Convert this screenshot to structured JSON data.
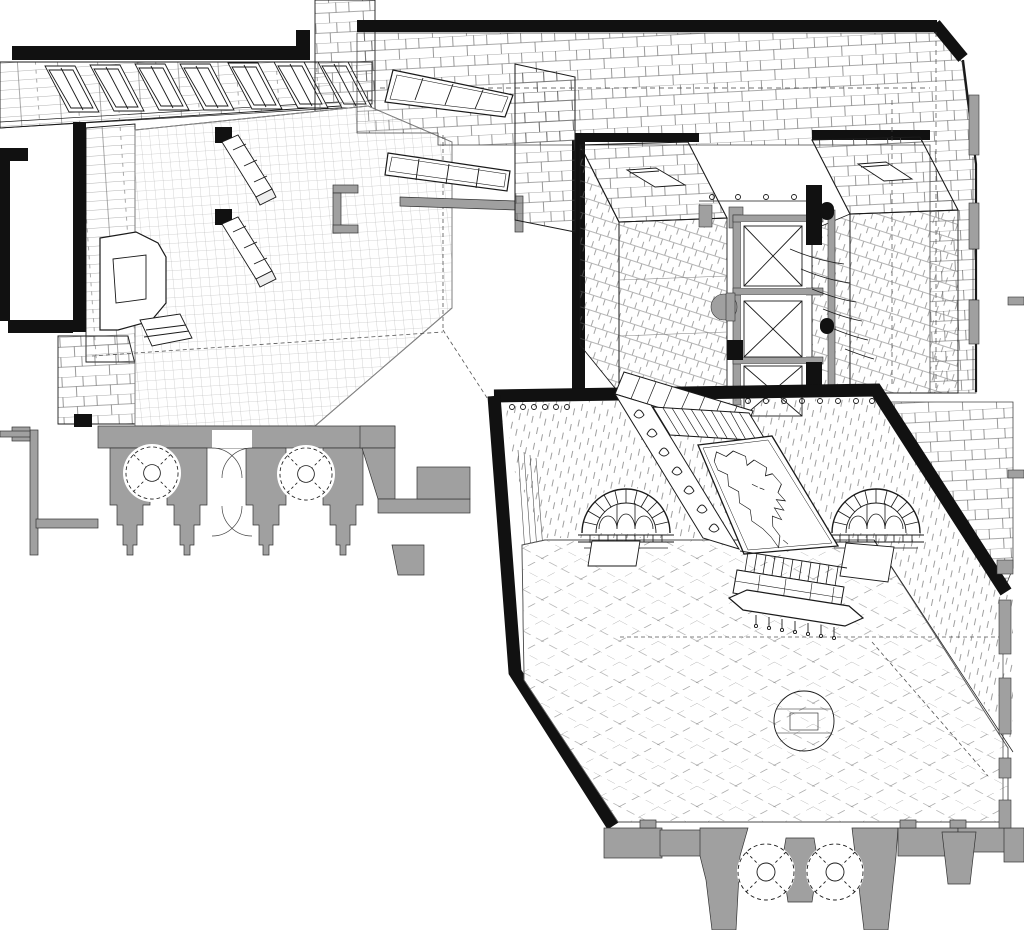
{
  "colors": {
    "paper": "#ffffff",
    "ink": "#111111",
    "line": "#2a2a2a",
    "wall_poche": "#a0a0a0",
    "hatch": "#666666",
    "grid": "#999999"
  },
  "components": {
    "counts": {
      "clerestory_windows": 7,
      "bridge_glazed_panels": 2,
      "stair_towers": 2,
      "elevator_shafts": 3,
      "arched_windows": 2,
      "hall_round_columns": 2,
      "left_wing_round_columns": 2,
      "map_murals": 1
    },
    "labels": [
      "entrance-lobby",
      "reception-desk",
      "bench-parapets",
      "clerestory-window-band",
      "skylight-bridge",
      "masonry-roof-band",
      "stair-tower-left",
      "stair-tower-right",
      "elevator-core",
      "great-hall",
      "arched-window-left",
      "arched-window-right",
      "north-america-map-mural",
      "mural-skylight-grille",
      "ornamental-border",
      "balustrade",
      "console-table",
      "floor-medallion",
      "stone-paving",
      "poche-cut-walls",
      "entry-columns",
      "door-swing-arcs",
      "window-mullion-poche"
    ]
  }
}
